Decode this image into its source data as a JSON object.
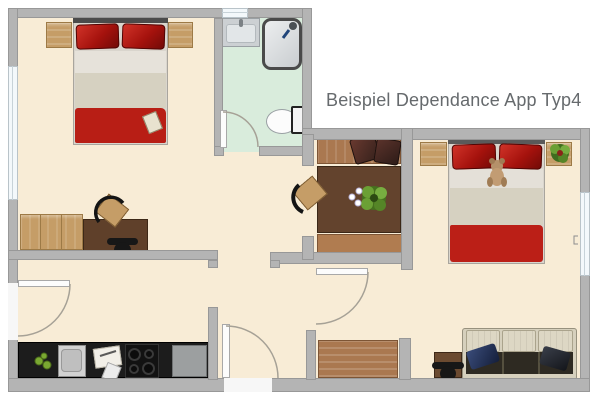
{
  "title": "Beispiel Dependance App Typ4",
  "palette": {
    "wall": "#b4b4b4",
    "wall_edge": "#989898",
    "floor": "#f8ecd6",
    "bath_floor": "#d9ecdc",
    "wood_light": "#c59d67",
    "wood_medium": "#aa7850",
    "wood_dark": "#5f402a",
    "bed_red": "#b81e15",
    "pillow_red": "#a5120d",
    "sofa_cream": "#d6d0bd",
    "kitchen_counter": "#1c1c1c",
    "plant_green": "#5c8f2b",
    "title_text": "#666a6d",
    "window": "#f3f8fb"
  },
  "rooms": [
    {
      "name": "bedroom-left",
      "furniture": [
        "double-bed",
        "nightstand",
        "nightstand",
        "dresser",
        "desk",
        "desk-chair",
        "wooden-chair"
      ]
    },
    {
      "name": "bathroom",
      "furniture": [
        "washbasin",
        "shower",
        "toilet"
      ]
    },
    {
      "name": "dining-nook",
      "furniture": [
        "bench",
        "bench",
        "dining-table",
        "plant",
        "chair",
        "cushions"
      ]
    },
    {
      "name": "bedroom-right",
      "furniture": [
        "double-bed",
        "nightstand",
        "nightstand-with-plant",
        "teddy-bear"
      ]
    },
    {
      "name": "living-kitchen",
      "furniture": [
        "kitchen-counter",
        "sink",
        "cutting-board",
        "cooktop",
        "counter-end-unit",
        "apples"
      ]
    },
    {
      "name": "hallway",
      "furniture": []
    },
    {
      "name": "sofa-room",
      "furniture": [
        "sofa",
        "side-table",
        "black-chair",
        "wooden-bench"
      ]
    }
  ]
}
